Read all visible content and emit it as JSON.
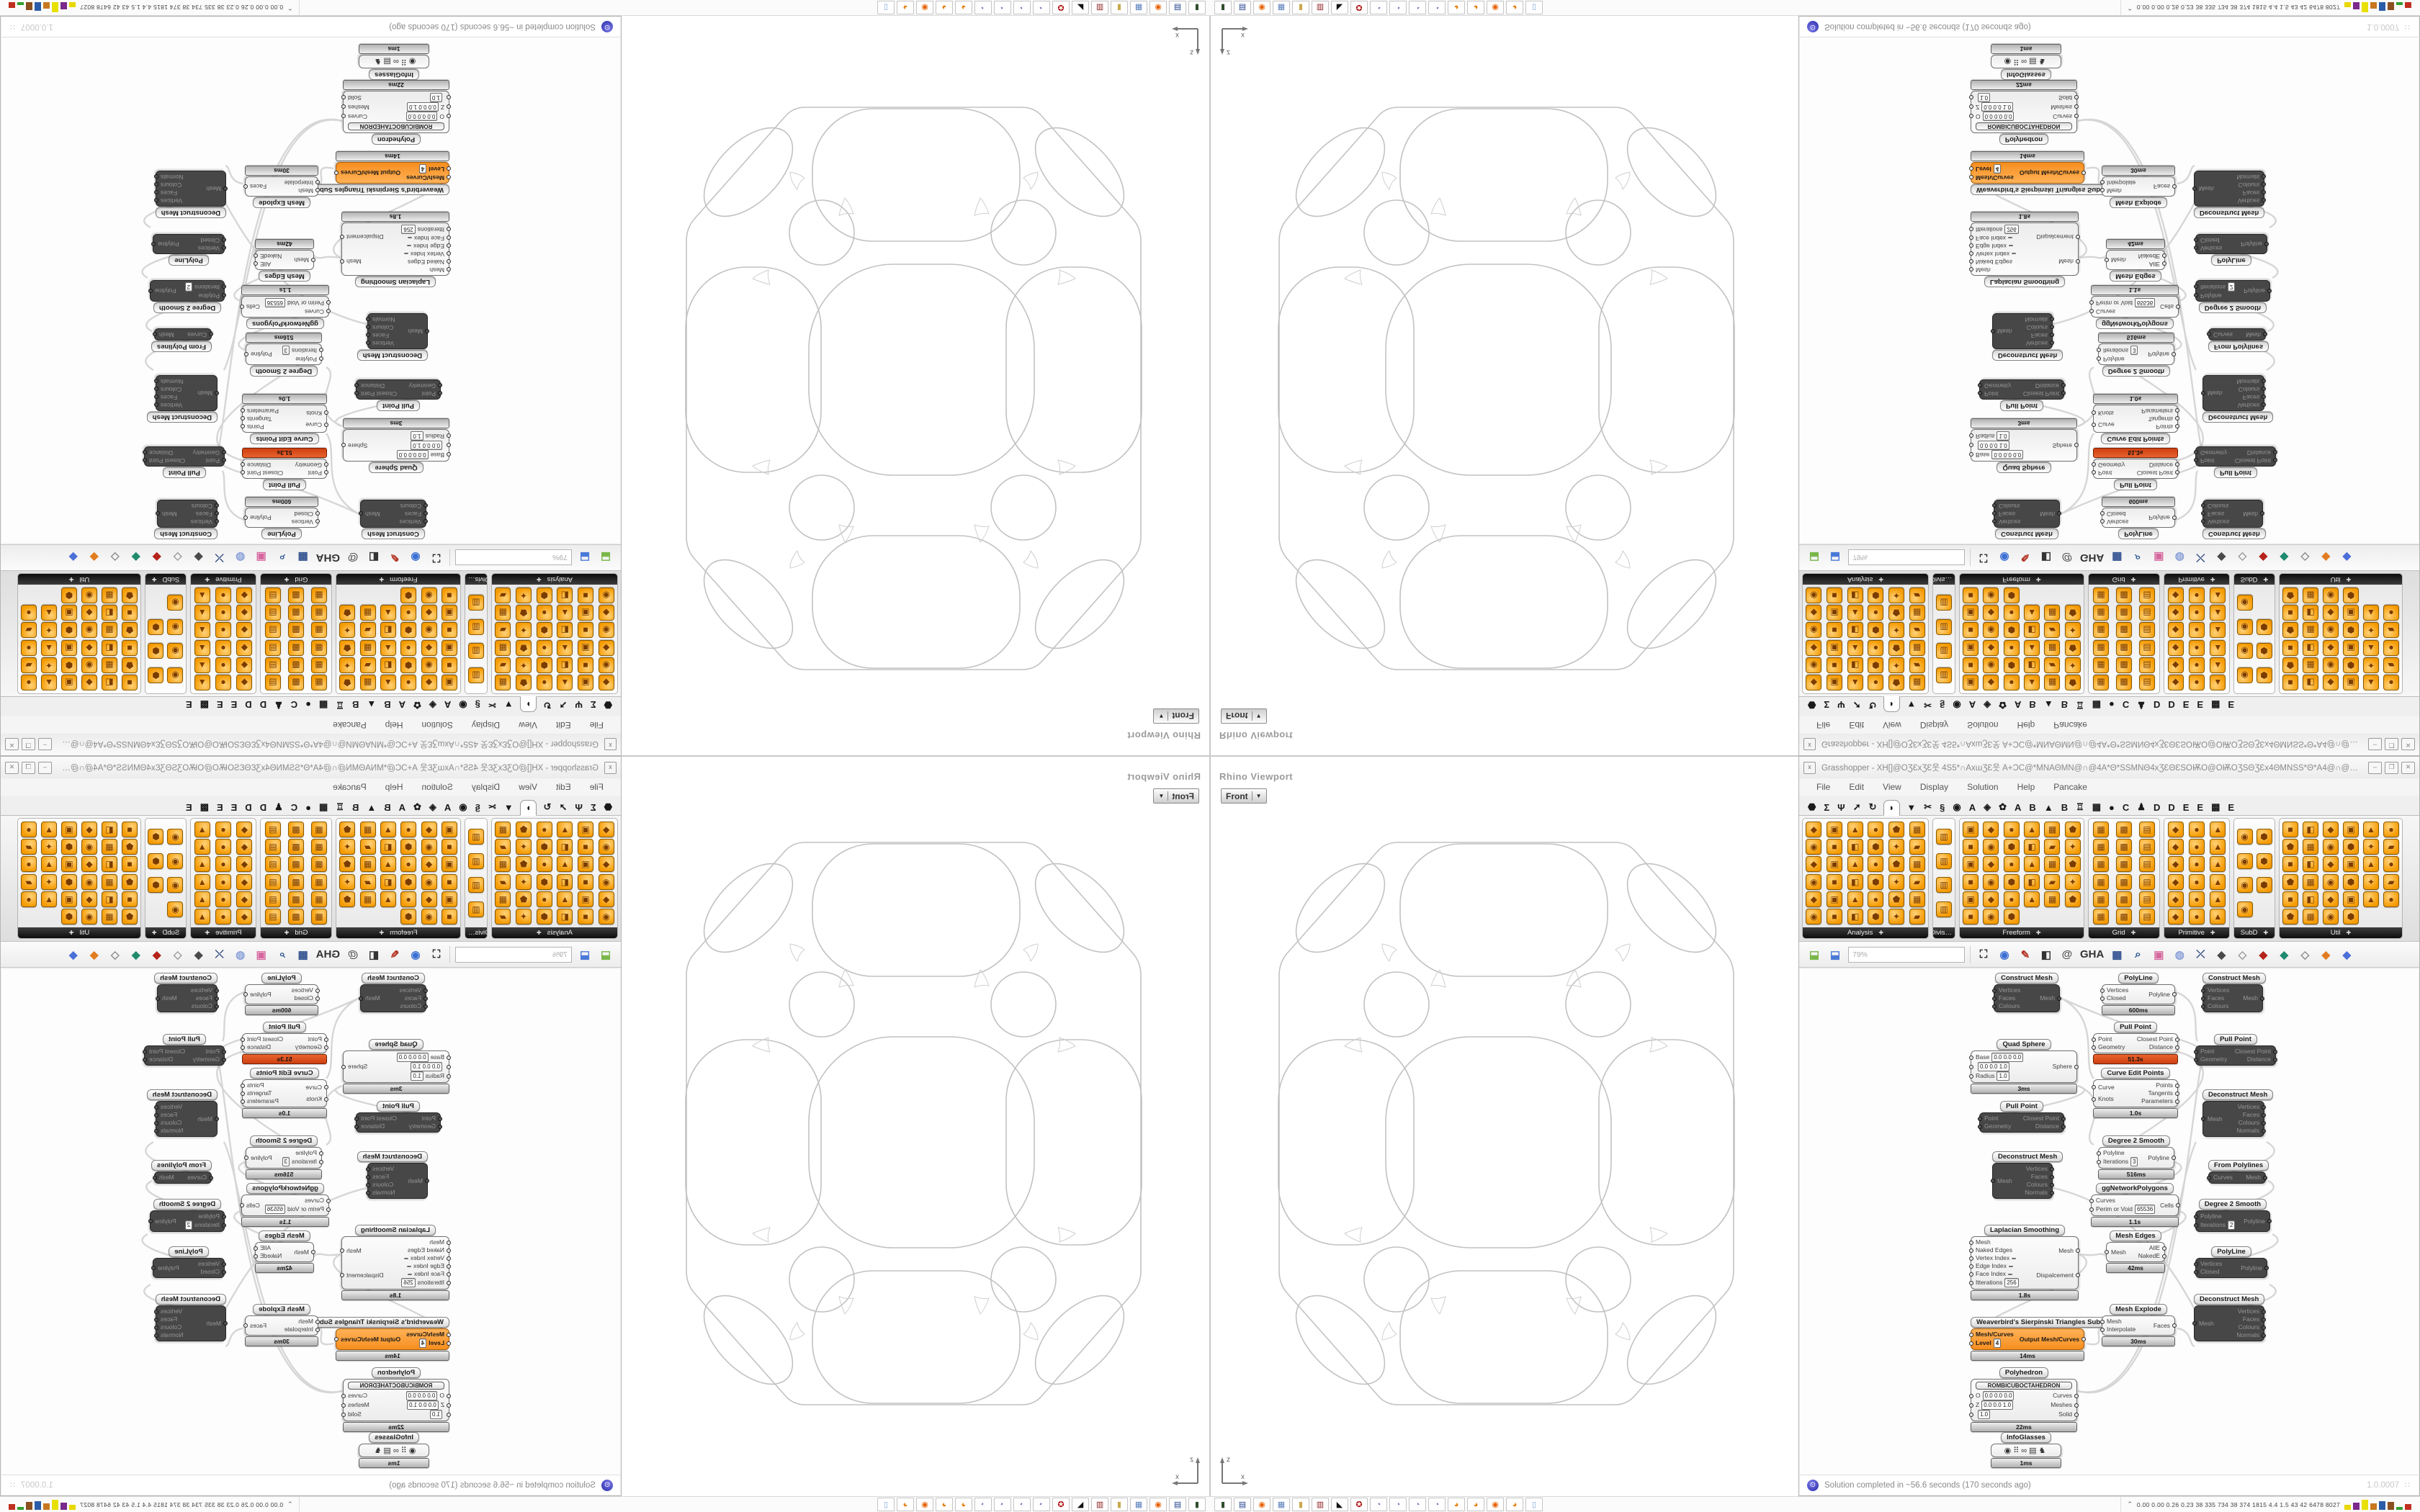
{
  "viewport": {
    "title": "Rhino Viewport",
    "projection": "Front",
    "axis": {
      "x": "x",
      "z": "z"
    }
  },
  "gh": {
    "close_glyph": "x",
    "title": "Grasshopper - XH[]@OƷƐxƷƐ웃 4S5*∩AxɯƷƐ웃 A+ƆC@*MNAΘMN@∩@4A*Θ*SSMNΘ4xƷƐΘƐSOѬO@OѬOƷSΘƷƐx4ΘMNSS*Θ*A4@∩@MNΘAMN*@ƆC4A웃ƷƐɯxA∩*...",
    "window_buttons": [
      {
        "g": "–",
        "name": "minimize"
      },
      {
        "g": "❐",
        "name": "maximize"
      },
      {
        "g": "✕",
        "name": "close"
      }
    ],
    "menu": [
      "File",
      "Edit",
      "View",
      "Display",
      "Solution",
      "Help",
      "Pancake"
    ],
    "tabs": [
      {
        "g": "⬣"
      },
      {
        "g": "Σ"
      },
      {
        "g": "Ψ"
      },
      {
        "g": "➚"
      },
      {
        "g": "↻"
      },
      {
        "g": "◗",
        "cls": "sel"
      },
      {
        "g": "▼"
      },
      {
        "g": "✂"
      },
      {
        "g": "§"
      },
      {
        "g": "◉"
      },
      {
        "g": "A"
      },
      {
        "g": "◈"
      },
      {
        "g": "✿"
      },
      {
        "g": "A"
      },
      {
        "g": "B"
      },
      {
        "g": "▲"
      },
      {
        "g": "B"
      },
      {
        "g": "♖"
      },
      {
        "g": "▦"
      },
      {
        "g": "●"
      },
      {
        "g": "C"
      },
      {
        "g": "♟"
      },
      {
        "g": "D"
      },
      {
        "g": "D"
      },
      {
        "g": "E"
      },
      {
        "g": "E"
      },
      {
        "g": "▩"
      },
      {
        "g": "E"
      }
    ],
    "ribbon": {
      "panels": [
        {
          "label": "Analysis",
          "arrow": "✚",
          "style": "width:176px;--cols:6",
          "icons": "◆▣▲●⬟▦◉■◧⬢✦▰◆▣▲●⬟▦◉■◧⬢✦▰◆▣▲●⬟▦◉■◧⬢✦▰"
        },
        {
          "label": "Divis…",
          "arrow": "",
          "style": "width:32px;--cols:1",
          "icons": "▥▥▥▥"
        },
        {
          "label": "Freeform",
          "arrow": "✚",
          "style": "width:174px;--cols:6",
          "icons": "▣◆●▲▦⬟■◉⬢◧▰✦▣◆●▲▦⬟■◉⬢◧▰✦▣◆●▲▦⬟■◉⬢"
        },
        {
          "label": "Grid",
          "arrow": "✚",
          "style": "width:100px;--cols:3",
          "icons": "▦▩▤▦▩▤▦▩▤▦▩▤▦▩▤▦▩▤"
        },
        {
          "label": "Primitive",
          "arrow": "✚",
          "style": "width:92px;--cols:3",
          "icons": "◆●▲◆●▲◆●▲◆●▲◆●▲◆●▲"
        },
        {
          "label": "SubD",
          "arrow": "✚",
          "style": "width:58px;--cols:2",
          "icons": "◉⬢◉⬢◉⬢◉"
        },
        {
          "label": "Util",
          "arrow": "✚",
          "style": "width:172px;--cols:6",
          "icons": "■◧◆▣▲●⬟▦◉⬢✦▰■◧◆▣▲●⬟▦◉⬢✦▰■◧◆▣▲●⬟▦◉⬢"
        }
      ]
    },
    "toolbar": {
      "zoom": "79%",
      "file_icons": [
        {
          "g": "⬓",
          "c": "#79b74a",
          "name": "open-file-icon"
        },
        {
          "g": "⬓",
          "c": "#4a79d8",
          "name": "save-file-icon"
        }
      ],
      "icons": [
        {
          "g": "⛶",
          "c": "#222222",
          "name": "zoom-extents-icon"
        },
        {
          "g": "◉",
          "c": "#3b6fd4",
          "name": "preview-eye-icon"
        },
        {
          "g": "✎",
          "c": "#b33426",
          "name": "sketch-icon"
        },
        {
          "g": "◧",
          "c": "#333333",
          "name": "exposure-icon"
        },
        {
          "g": "@",
          "c": "#555555",
          "name": "annotations-icon"
        },
        {
          "g": "GHA",
          "c": "#333333",
          "name": "gha-icon"
        },
        {
          "g": "▦",
          "c": "#2f4f8f",
          "name": "image-icon"
        },
        {
          "g": "⌕",
          "c": "#1f4e8c",
          "name": "finder-icon"
        },
        {
          "g": "▣",
          "c": "#d6679f",
          "name": "help-icon"
        },
        {
          "g": "◍",
          "c": "#8aa0d8",
          "name": "idea-icon"
        },
        {
          "g": "⤫",
          "c": "#26417a",
          "name": "wire-display-icon"
        },
        {
          "g": "◆",
          "c": "#4a4a4a",
          "name": "gem-dark-icon"
        },
        {
          "g": "◇",
          "c": "#9a9a9a",
          "name": "gem-light-icon"
        },
        {
          "g": "◆",
          "c": "#b5231a",
          "name": "gem-red-icon"
        },
        {
          "g": "◆",
          "c": "#1f8a6e",
          "name": "gem-teal-icon"
        },
        {
          "g": "◇",
          "c": "#8a8a8a",
          "name": "gem-gray-icon"
        },
        {
          "g": "◆",
          "c": "#e07c1f",
          "name": "gem-orange-icon"
        },
        {
          "g": "◆",
          "c": "#4a6fd8",
          "name": "gem-blue-icon"
        }
      ]
    },
    "canvas": {
      "nodes": [
        {
          "type": "n-dark",
          "style": "left:270px;top:300px;width:92px",
          "title": "Construct Mesh",
          "inputs": [
            {
              "label": "Vertices"
            },
            {
              "label": "Faces"
            },
            {
              "label": "Colours"
            }
          ],
          "outputs": [
            {
              "label": "Mesh"
            }
          ]
        },
        {
          "type": "n-white",
          "style": "left:420px;top:300px;width:102px",
          "title": "PolyLine",
          "inputs": [
            {
              "label": "Vertices"
            },
            {
              "label": "Closed"
            }
          ],
          "outputs": [
            {
              "label": "Polyline"
            }
          ],
          "timer": "600ms"
        },
        {
          "type": "n-white",
          "style": "left:408px;top:368px;width:118px",
          "title": "Pull Point",
          "inputs": [
            {
              "label": "Point"
            },
            {
              "label": "Geometry"
            }
          ],
          "outputs": [
            {
              "label": "Closest Point"
            },
            {
              "label": "Distance"
            }
          ],
          "timer": "51.3s",
          "timerClass": "timer-red"
        },
        {
          "type": "n-white",
          "style": "left:408px;top:432px;width:118px",
          "title": "Curve Edit Points",
          "inputs": [
            {
              "label": "Curve"
            },
            {
              "label": "Knots"
            }
          ],
          "outputs": [
            {
              "label": "Points"
            },
            {
              "label": "Tangents"
            },
            {
              "label": "Parameters"
            }
          ],
          "timer": "1.0s"
        },
        {
          "type": "n-white",
          "style": "left:238px;top:392px;width:148px",
          "title": "Quad Sphere",
          "inputs": [
            {
              "label": "Base",
              "field": "0.0 0.0 0.0"
            },
            {
              "label": "",
              "field": "0.0 0.0 1.0"
            },
            {
              "label": "Radius",
              "field": "1.0"
            }
          ],
          "outputs": [
            {
              "label": "Sphere"
            }
          ],
          "timer": "3ms"
        },
        {
          "type": "n-dark",
          "style": "left:250px;top:478px;width:118px",
          "title": "Pull Point",
          "inputs": [
            {
              "label": "Point"
            },
            {
              "label": "Geometry"
            }
          ],
          "outputs": [
            {
              "label": "Closest Point"
            },
            {
              "label": "Distance"
            }
          ]
        },
        {
          "type": "n-dark",
          "style": "left:560px;top:300px;width:84px",
          "title": "Construct Mesh",
          "inputs": [
            {
              "label": "Vertices"
            },
            {
              "label": "Faces"
            },
            {
              "label": "Colours"
            }
          ],
          "outputs": [
            {
              "label": "Mesh"
            }
          ]
        },
        {
          "type": "n-dark",
          "style": "left:550px;top:385px;width:112px",
          "title": "Pull Point",
          "inputs": [
            {
              "label": "Point"
            },
            {
              "label": "Geometry"
            }
          ],
          "outputs": [
            {
              "label": "Closest Point"
            },
            {
              "label": "Distance"
            }
          ]
        },
        {
          "type": "n-dark",
          "style": "left:560px;top:462px;width:86px",
          "title": "Deconstruct Mesh",
          "inputs": [
            {
              "label": "Mesh"
            }
          ],
          "outputs": [
            {
              "label": "Vertices"
            },
            {
              "label": "Faces"
            },
            {
              "label": "Colours"
            },
            {
              "label": "Normals"
            }
          ]
        },
        {
          "type": "n-dark",
          "style": "left:568px;top:560px;width:80px",
          "title": "From Polylines",
          "inputs": [
            {
              "label": "Curves"
            }
          ],
          "outputs": [
            {
              "label": "Mesh"
            }
          ]
        },
        {
          "type": "n-dark",
          "style": "left:550px;top:614px;width:104px",
          "title": "Degree 2 Smooth",
          "inputs": [
            {
              "label": "Polyline"
            },
            {
              "label": "Iterations",
              "field": "2"
            }
          ],
          "outputs": [
            {
              "label": "Polyline"
            }
          ]
        },
        {
          "type": "n-dark",
          "style": "left:550px;top:680px;width:100px",
          "title": "PolyLine",
          "inputs": [
            {
              "label": "Vertices"
            },
            {
              "label": "Closed"
            }
          ],
          "outputs": [
            {
              "label": "Polyline"
            }
          ]
        },
        {
          "type": "n-dark",
          "style": "left:548px;top:746px;width:98px",
          "title": "Deconstruct Mesh",
          "inputs": [
            {
              "label": "Mesh"
            }
          ],
          "outputs": [
            {
              "label": "Vertices"
            },
            {
              "label": "Faces"
            },
            {
              "label": "Colours"
            },
            {
              "label": "Normals"
            }
          ]
        },
        {
          "type": "n-white",
          "style": "left:415px;top:526px;width:106px",
          "title": "Degree 2 Smooth",
          "inputs": [
            {
              "label": "Polyline"
            },
            {
              "label": "Iterations",
              "field": "3"
            }
          ],
          "outputs": [
            {
              "label": "Polyline"
            }
          ],
          "timer": "516ms"
        },
        {
          "type": "n-white",
          "style": "left:405px;top:592px;width:122px",
          "title": "ggNetworkPolygons",
          "inputs": [
            {
              "label": "Curves"
            },
            {
              "label": "Perim or Void",
              "field": "65536"
            }
          ],
          "outputs": [
            {
              "label": "Cells"
            }
          ],
          "timer": "1.1s"
        },
        {
          "type": "n-white",
          "style": "left:426px;top:658px;width:82px",
          "title": "Mesh Edges",
          "inputs": [
            {
              "label": "Mesh"
            }
          ],
          "outputs": [
            {
              "label": "AllE"
            },
            {
              "label": "NakedE"
            }
          ],
          "timer": "42ms"
        },
        {
          "type": "n-dark",
          "style": "left:268px;top:548px;width:84px",
          "title": "Deconstruct Mesh",
          "inputs": [
            {
              "label": "Mesh"
            }
          ],
          "outputs": [
            {
              "label": "Vertices"
            },
            {
              "label": "Faces"
            },
            {
              "label": "Colours"
            },
            {
              "label": "Normals"
            }
          ]
        },
        {
          "type": "n-white",
          "style": "left:238px;top:650px;width:150px",
          "title": "Laplacian Smoothing",
          "inputs": [
            {
              "label": "Mesh"
            },
            {
              "label": "Naked Edges"
            },
            {
              "label": "Vertex Index",
              "field": " "
            },
            {
              "label": "Edge Index",
              "field": " "
            },
            {
              "label": "Face Index",
              "field": " "
            },
            {
              "label": "Itterations",
              "field": "256"
            }
          ],
          "outputs": [
            {
              "label": "Mesh"
            },
            {
              "label": "Dispalcement"
            }
          ],
          "timer": "1.8s"
        },
        {
          "type": "n-orange",
          "style": "left:238px;top:778px;width:158px",
          "title": "Weaverbird's Sierpinski Triangles Subdivision",
          "inputs": [
            {
              "label": "Mesh/Curves"
            },
            {
              "label": "Level",
              "field": "4"
            }
          ],
          "outputs": [
            {
              "label": "Output Mesh/Curves"
            }
          ],
          "timer": "14ms"
        },
        {
          "type": "n-white",
          "style": "left:238px;top:848px;width:148px",
          "title": "Polyhedron",
          "button": "ROMBICUBOCTAHEDRON",
          "inputs": [
            {
              "label": "O",
              "field": "0.0 0.0 0.0"
            },
            {
              "label": "Z",
              "field": "0.0 0.0 1.0"
            },
            {
              "label": "",
              "field": "1.0"
            }
          ],
          "outputs": [
            {
              "label": "Curves"
            },
            {
              "label": "Meshes"
            },
            {
              "label": "Solid"
            }
          ],
          "timer": "22ms"
        },
        {
          "type": "n-white",
          "style": "left:266px;top:938px;width:98px",
          "title": "InfoGlasses",
          "center": "◉⠿∞▤♞",
          "inputs": [],
          "outputs": [],
          "timer": "1ms"
        },
        {
          "type": "n-white",
          "style": "left:420px;top:760px;width:102px",
          "title": "Mesh Explode",
          "inputs": [
            {
              "label": "Mesh"
            },
            {
              "label": "Interpolate"
            }
          ],
          "outputs": [
            {
              "label": "Faces"
            }
          ],
          "timer": "30ms"
        }
      ]
    },
    "status": {
      "icon": "⊙",
      "text": "Solution completed in ~56.6 seconds (170 seconds ago)",
      "version": "1.0.0007",
      "grip": "∷"
    }
  },
  "taskbar": {
    "apps": [
      {
        "g": "▮",
        "c": "#2f4f2f"
      },
      {
        "g": "▤",
        "c": "#24418c"
      },
      {
        "g": "◉",
        "c": "#e66000"
      },
      {
        "g": "▦",
        "c": "#5b7fbd"
      },
      {
        "g": "▮",
        "c": "#c9a84c"
      },
      {
        "g": "▥",
        "c": "#8b1a1a"
      },
      {
        "g": "◣",
        "c": "#111111"
      },
      {
        "g": "✪",
        "c": "#b01212"
      },
      {
        "g": "◔",
        "c": "#7a5ab8"
      },
      {
        "g": "◔",
        "c": "#7a5ab8"
      },
      {
        "g": "◔",
        "c": "#7a5ab8"
      },
      {
        "g": "◔",
        "c": "#7a5ab8"
      },
      {
        "g": "◕",
        "c": "#e87d0d"
      },
      {
        "g": "◕",
        "c": "#e87d0d"
      },
      {
        "g": "◉",
        "c": "#e66000"
      },
      {
        "g": "◕",
        "c": "#e87d0d"
      },
      {
        "g": "▯",
        "c": "#7aa6d8"
      }
    ],
    "stats": {
      "arrow": "⌃",
      "values": "0.00 0.00 0.26 0.23  38  335  734  38  374 1815 4.4  1.5  43  42  6478 8027",
      "bars": [
        {
          "c": "#e8d800",
          "style": "height:7px"
        },
        {
          "c": "#7a2a8a",
          "style": "height:10px"
        },
        {
          "c": "#e8e000",
          "style": "height:14px"
        },
        {
          "c": "#c87820",
          "style": "height:9px"
        },
        {
          "c": "#2a5ca8",
          "style": "height:12px"
        },
        {
          "c": "#8a5020",
          "style": "height:11px"
        },
        {
          "c": "#30a030",
          "style": "height:4px"
        },
        {
          "c": "#c03020",
          "style": "height:8px"
        }
      ]
    }
  }
}
